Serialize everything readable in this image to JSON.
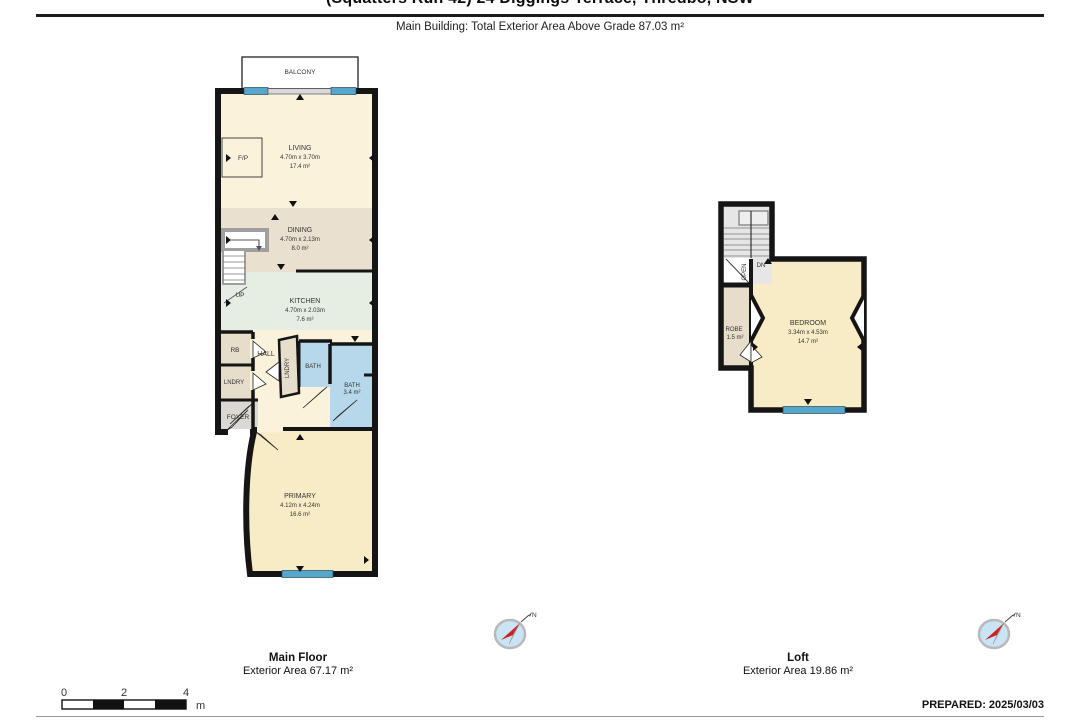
{
  "header": {
    "title": "(Squatters Run 42) 24 Diggings Terrace, Thredbo, NSW",
    "subtitle": "Main Building: Total Exterior Area Above Grade 87.03 m²"
  },
  "main_floor": {
    "balcony_label": "BALCONY",
    "rooms": {
      "living": {
        "name": "LIVING",
        "dims": "4.70m x 3.70m",
        "area": "17.4 m²"
      },
      "dining": {
        "name": "DINING",
        "dims": "4.70m x 2.13m",
        "area": "8.0 m²"
      },
      "kitchen": {
        "name": "KITCHEN",
        "dims": "4.70m x 2.03m",
        "area": "7.6 m²"
      },
      "primary": {
        "name": "PRIMARY",
        "dims": "4.12m x 4.24m",
        "area": "16.6 m²"
      },
      "bath": {
        "name": "BATH",
        "area": "3.4 m²"
      },
      "bath_small": "BATH",
      "hall": "HALL",
      "rb": "RB",
      "laundry": "LNDRY",
      "laundry_closet": "LNDRY",
      "foyer": "FOYER",
      "fireplace": "F/P",
      "up": "UP"
    },
    "caption": {
      "title": "Main Floor",
      "area": "Exterior Area 67.17 m²"
    }
  },
  "loft": {
    "rooms": {
      "bedroom": {
        "name": "BEDROOM",
        "dims": "3.34m x 4.53m",
        "area": "14.7 m²"
      },
      "robe": {
        "name": "ROBE",
        "area": "1.5 m²"
      },
      "open": "OPEN",
      "dn": "DN"
    },
    "caption": {
      "title": "Loft",
      "area": "Exterior Area 19.86 m²"
    }
  },
  "scale_bar": {
    "ticks": [
      "0",
      "2",
      "4"
    ],
    "unit": "m"
  },
  "compass": {
    "north": "N"
  },
  "footer": {
    "prepared": "PREPARED: 2025/03/03"
  },
  "colors": {
    "wall": "#151515",
    "living_cream": "#faf2da",
    "dining_tan": "#e9e0d0",
    "kitchen_mint": "#e6eee4",
    "primary_yellow": "#f8ecc6",
    "bath_blue": "#b7d8eb",
    "foyer_gray": "#dbd7d3",
    "closet_tan": "#e6ddcb",
    "window_blue": "#57a6cc",
    "compass_blue": "#c9e4f5",
    "compass_red": "#cc2222"
  }
}
